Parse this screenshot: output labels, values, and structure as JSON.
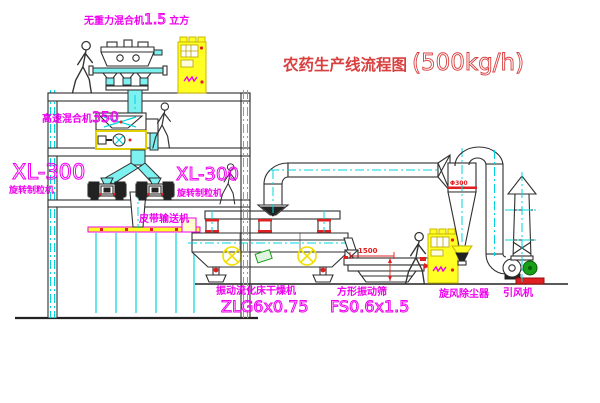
{
  "title": {
    "zh": "农药生产线流程图",
    "capacity": "(500kg/h)"
  },
  "equipment_labels": {
    "gravity_mixer": {
      "name": "无重力混合机",
      "spec": "1.5",
      "unit": "立方"
    },
    "high_speed_mixer": {
      "name": "高速混合机",
      "spec": "350"
    },
    "granulator_left": {
      "model": "XL-300",
      "name": "旋转制粒机"
    },
    "granulator_right": {
      "model": "XL-300",
      "name": "旋转制粒机"
    },
    "belt_conveyor": {
      "name": "皮带输送机"
    },
    "fluid_bed_dryer": {
      "name": "振动流化床干燥机",
      "model": "ZLG6x0.75"
    },
    "vibrating_screen": {
      "name": "方形振动筛",
      "model": "FS0.6x1.5"
    },
    "cyclone": {
      "name": "旋风除尘器"
    },
    "fan": {
      "name": "引风机"
    }
  },
  "dimensions": {
    "screen_length": "1500",
    "cyclone_diameter": "Φ300"
  },
  "colors": {
    "label_magenta": "#ef00ef",
    "title_red": "#d84040",
    "dimension_red": "#e02020",
    "centerline_cyan": "#00d4dc",
    "cabinet_yellow": "#ffff24",
    "motor_green": "#18a018",
    "line_dark": "#2f2f2f"
  }
}
